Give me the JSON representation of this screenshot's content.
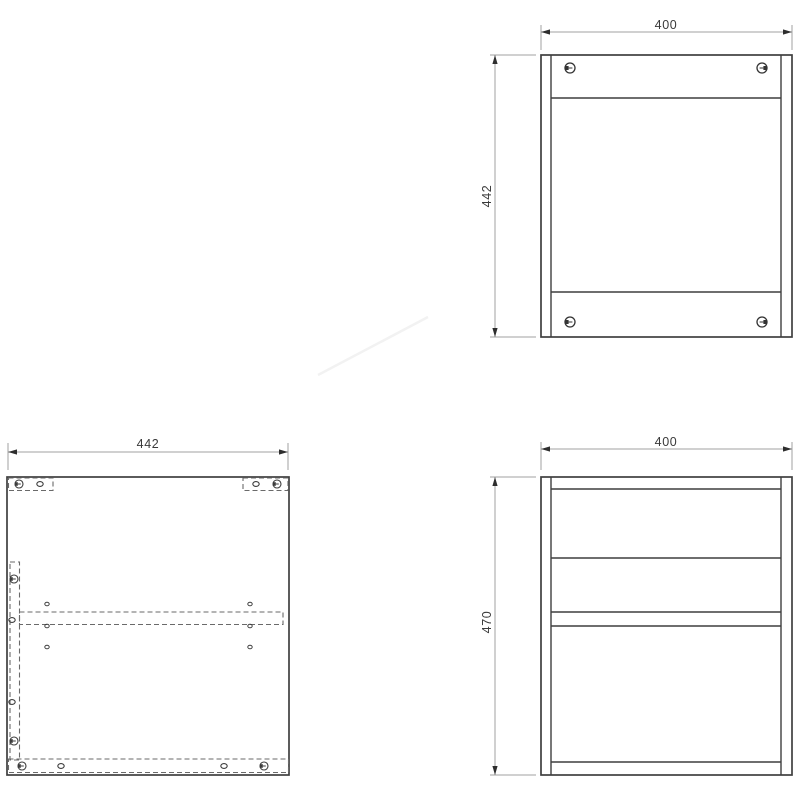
{
  "drawing": {
    "type": "furniture-technical-drawing",
    "views": {
      "back_panel": {
        "name": "back panel view (top right)",
        "width": "400",
        "height": "442"
      },
      "side_panel": {
        "name": "side panel view (bottom left)",
        "width": "442"
      },
      "front_view": {
        "name": "carcass side view (bottom right)",
        "width": "400",
        "height": "470"
      }
    },
    "colors": {
      "background": "#ffffff",
      "part_line": "#3f3f3f",
      "hidden_line": "#6a6a6a",
      "dimension_line": "#a0a0a0",
      "arrow": "#2e2e2e",
      "text": "#3a3a3a"
    },
    "icons": {
      "cam_lock": "cam-lock-fastener-icon",
      "dowel": "dowel-hole-icon",
      "pin": "shelf-pin-hole-icon"
    }
  }
}
